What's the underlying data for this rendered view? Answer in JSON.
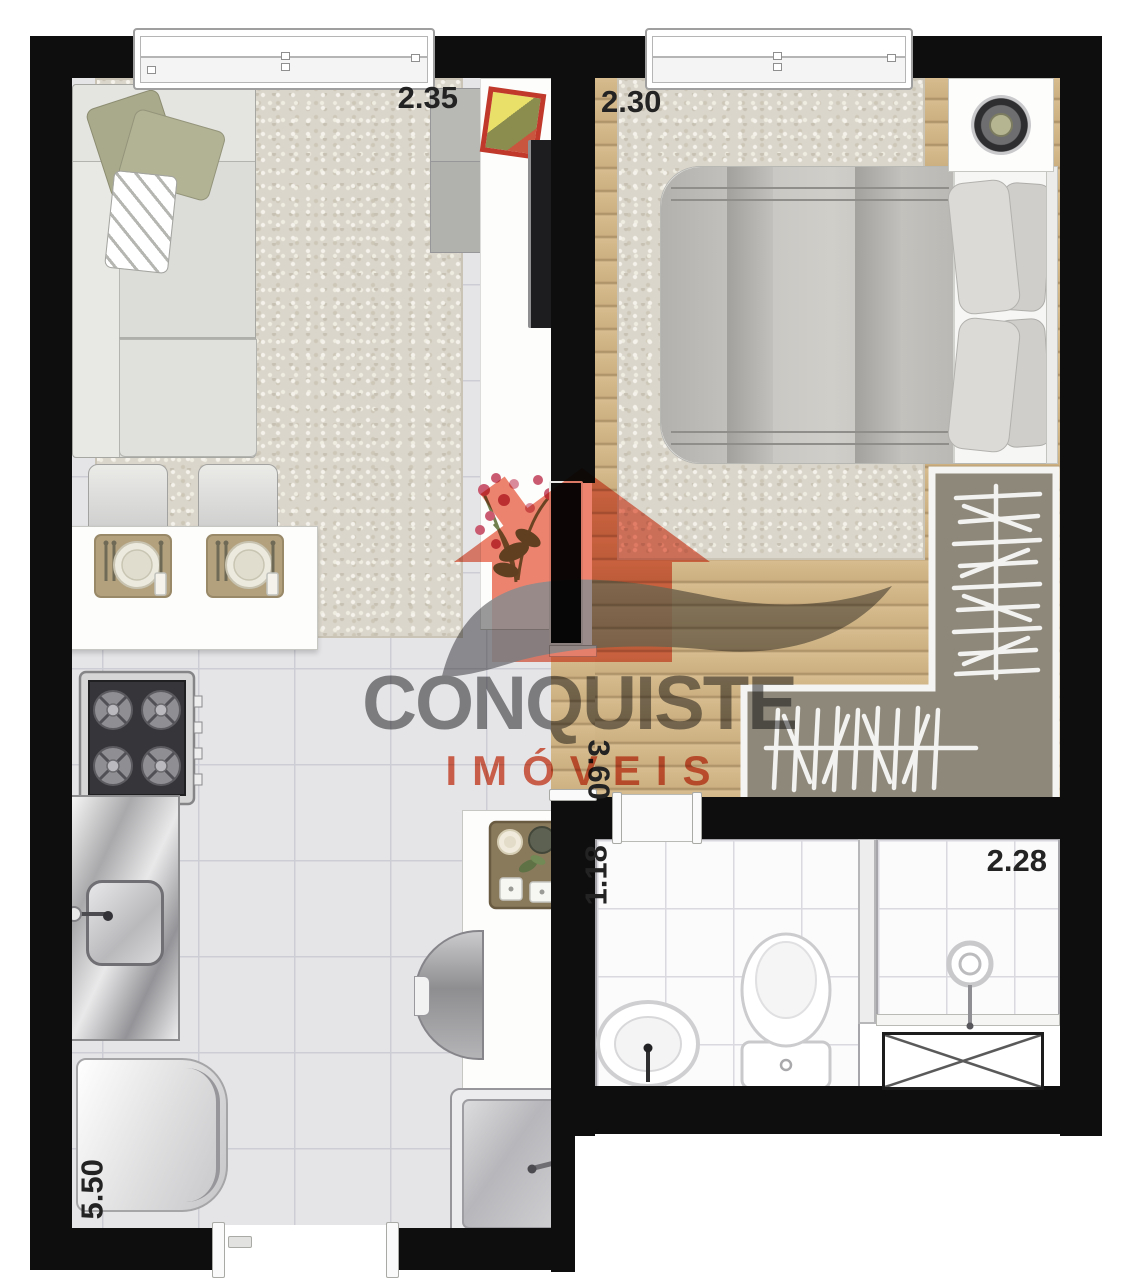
{
  "watermark": {
    "brand": "CONQUISTE",
    "tagline": "IMÓVEIS"
  },
  "measurements": {
    "living_width": "2.35",
    "bedroom_width": "2.30",
    "bedroom_length": "3.60",
    "bathroom_width": "1.18",
    "shower_width": "2.28",
    "apartment_length": "5.50"
  },
  "palette": {
    "wall": "#0e0e0e",
    "wood_floor": "#cdb185",
    "tile_floor": "#e5e5e8",
    "bath_tile": "#fbfbfc",
    "rug": "#dbd6cb",
    "closet_interior": "#8e887b",
    "brand_gray": "#8a8a8c",
    "brand_salmon": "#e8705a",
    "measurement_text": "#232323"
  }
}
